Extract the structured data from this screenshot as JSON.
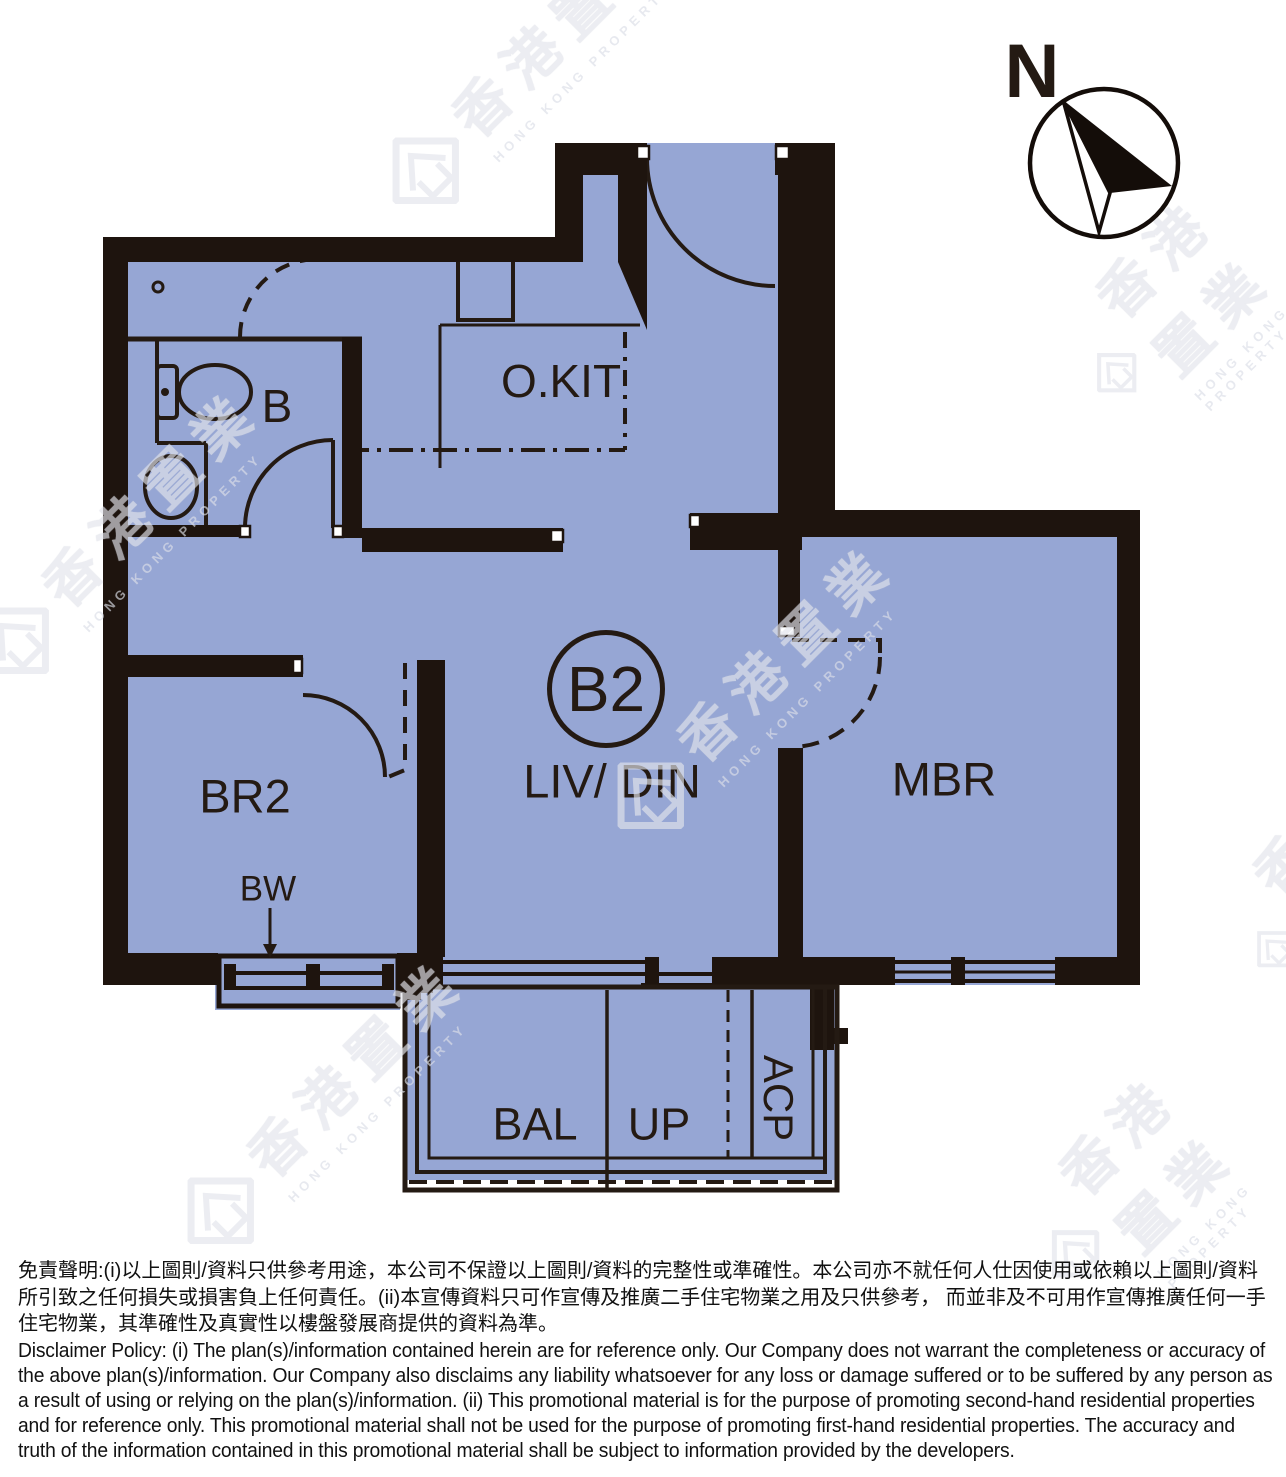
{
  "unit": {
    "label": "B2"
  },
  "compass": {
    "north_label": "N"
  },
  "rooms": {
    "bathroom": "B",
    "open_kitchen": "O.KIT",
    "living_dining": "LIV/ DIN",
    "master_bedroom": "MBR",
    "bedroom2": "BR2",
    "bay_window": "BW",
    "balcony": "BAL",
    "up": "UP",
    "ac_platform": "ACP"
  },
  "watermark": {
    "cn": "香港置業",
    "en": "HONG KONG PROPERTY"
  },
  "disclaimer": {
    "zh": "免責聲明:(i)以上圖則/資料只供參考用途，本公司不保證以上圖則/資料的完整性或準確性。本公司亦不就任何人仕因使用或依賴以上圖則/資料所引致之任何損失或損害負上任何責任。(ii)本宣傳資料只可作宣傳及推廣二手住宅物業之用及只供參考， 而並非及不可用作宣傳推廣任何一手住宅物業，其準確性及真實性以樓盤發展商提供的資料為準。",
    "en": "Disclaimer Policy: (i) The plan(s)/information contained herein are for reference only. Our Company does not warrant the completeness or accuracy of the above plan(s)/information. Our Company also disclaims any liability whatsoever for any loss or damage suffered or to be suffered by any person as a result of using or relying on the plan(s)/information. (ii) This promotional material is for the purpose of promoting second-hand residential properties and for reference only. This promotional material shall not be used for the purpose of promoting first-hand residential properties. The accuracy and truth of the information contained in this promotional material shall be subject to information provided by the developers."
  },
  "colors": {
    "floor": "#96a6d4",
    "wall": "#1e140e",
    "line": "#241a13",
    "watermark": "#e3e5ec"
  }
}
